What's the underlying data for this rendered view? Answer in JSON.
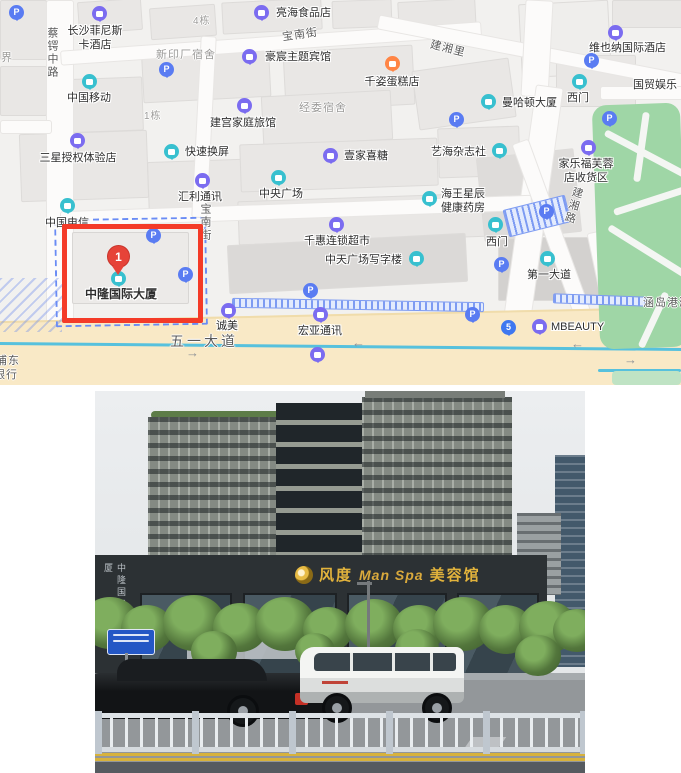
{
  "map": {
    "marker": {
      "number": "1",
      "label": "中隆国际大厦"
    },
    "streets": [
      {
        "t": "蔡锷中路",
        "x": 44,
        "y": 27,
        "vert": 1,
        "c": "dark"
      },
      {
        "t": "界",
        "x": 1,
        "y": 49,
        "c": "gray"
      },
      {
        "t": "宝南街",
        "x": 282,
        "y": 26,
        "rot": -8,
        "c": "dark"
      },
      {
        "t": "宝南街",
        "x": 197,
        "y": 203,
        "vert": 1,
        "c": "dark"
      },
      {
        "t": "建湘里",
        "x": 430,
        "y": 40,
        "rot": 14,
        "c": "dark"
      },
      {
        "t": "建湘路",
        "x": 565,
        "y": 186,
        "vert": 1,
        "rot": 16,
        "c": "dark"
      },
      {
        "t": "五一大道",
        "x": 170,
        "y": 331,
        "size": 14,
        "c": "dark",
        "ls": 3
      },
      {
        "t": "新印厂宿舍",
        "x": 156,
        "y": 46,
        "c": "gray"
      },
      {
        "t": "经委宿舍",
        "x": 299,
        "y": 99,
        "c": "gray"
      },
      {
        "t": "4栋",
        "x": 193,
        "y": 12,
        "c": "gray",
        "size": 10
      },
      {
        "t": "1栋",
        "x": 144,
        "y": 107,
        "c": "gray",
        "size": 10
      },
      {
        "t": "浦东",
        "x": -4,
        "y": 352,
        "c": "dark"
      },
      {
        "t": "银行",
        "x": -6,
        "y": 366,
        "c": "dark"
      },
      {
        "t": "涵岛港湾",
        "x": 643,
        "y": 294,
        "c": "dark"
      }
    ],
    "pois": [
      {
        "n": "changsha-finisi-hotel",
        "icon": {
          "c": "purple",
          "x": 100,
          "y": 14
        },
        "label": {
          "t": "长沙菲尼斯\n卡酒店",
          "x": 95,
          "y": 25,
          "a": "c"
        }
      },
      {
        "n": "lianghai-food-store",
        "icon": {
          "c": "purple",
          "x": 262,
          "y": 13
        },
        "label": {
          "t": "亮海食品店",
          "x": 276,
          "y": 7,
          "a": "l"
        }
      },
      {
        "n": "haochen-theme-hotel",
        "icon": {
          "c": "purple",
          "x": 250,
          "y": 57
        },
        "label": {
          "t": "豪宸主题宾馆",
          "x": 265,
          "y": 51,
          "a": "l"
        }
      },
      {
        "n": "qianzi-cake-shop",
        "icon": {
          "c": "orange",
          "x": 393,
          "y": 64
        },
        "label": {
          "t": "千姿蛋糕店",
          "x": 392,
          "y": 76,
          "a": "c"
        }
      },
      {
        "n": "vienna-intl-hotel",
        "icon": {
          "c": "purple",
          "x": 616,
          "y": 33
        },
        "label": {
          "t": "维也纳国际酒店",
          "x": 589,
          "y": 42,
          "a": "l"
        }
      },
      {
        "n": "guomao-entertainment",
        "label": {
          "t": "国贸娱乐",
          "x": 633,
          "y": 79,
          "a": "l"
        }
      },
      {
        "n": "ximen-gate-north",
        "icon": {
          "c": "teal",
          "x": 580,
          "y": 82
        },
        "label": {
          "t": "西门",
          "x": 578,
          "y": 92,
          "a": "c"
        }
      },
      {
        "n": "manhattan-tower",
        "icon": {
          "c": "teal",
          "x": 489,
          "y": 102
        },
        "label": {
          "t": "曼哈顿大厦",
          "x": 502,
          "y": 97,
          "a": "l"
        }
      },
      {
        "n": "china-mobile",
        "icon": {
          "c": "teal",
          "x": 90,
          "y": 82
        },
        "label": {
          "t": "中国移动",
          "x": 89,
          "y": 92,
          "a": "c"
        }
      },
      {
        "n": "jiangong-family-inn",
        "icon": {
          "c": "purple",
          "x": 245,
          "y": 106
        },
        "label": {
          "t": "建宫家庭旅馆",
          "x": 243,
          "y": 117,
          "a": "c"
        }
      },
      {
        "n": "kuaisu-screen-repair",
        "icon": {
          "c": "teal",
          "x": 172,
          "y": 152
        },
        "label": {
          "t": "快速换屏",
          "x": 185,
          "y": 146,
          "a": "l"
        }
      },
      {
        "n": "samsung-store",
        "icon": {
          "c": "purple",
          "x": 78,
          "y": 141
        },
        "label": {
          "t": "三星授权体验店",
          "x": 78,
          "y": 152,
          "a": "c"
        }
      },
      {
        "n": "huili-telecom",
        "icon": {
          "c": "purple",
          "x": 203,
          "y": 181
        },
        "label": {
          "t": "汇利通讯",
          "x": 200,
          "y": 191,
          "a": "c"
        }
      },
      {
        "n": "china-telecom",
        "icon": {
          "c": "teal",
          "x": 68,
          "y": 206
        },
        "label": {
          "t": "中国电信",
          "x": 67,
          "y": 217,
          "a": "c"
        }
      },
      {
        "n": "yijia-candy",
        "icon": {
          "c": "purple",
          "x": 331,
          "y": 156
        },
        "label": {
          "t": "壹家喜糖",
          "x": 344,
          "y": 150,
          "a": "l"
        }
      },
      {
        "n": "zhongyang-plaza",
        "icon": {
          "c": "teal",
          "x": 279,
          "y": 178
        },
        "label": {
          "t": "中央广场",
          "x": 281,
          "y": 188,
          "a": "c"
        }
      },
      {
        "n": "yihai-magazine",
        "icon": {
          "c": "teal",
          "x": 500,
          "y": 151
        },
        "label": {
          "t": "艺海杂志社",
          "x": 431,
          "y": 146,
          "a": "l"
        }
      },
      {
        "n": "carrefour-pickup",
        "icon": {
          "c": "purple",
          "x": 589,
          "y": 148
        },
        "label": {
          "t": "家乐福芙蓉\n店收货区",
          "x": 586,
          "y": 158,
          "a": "c"
        }
      },
      {
        "n": "haiwang-pharmacy",
        "icon": {
          "c": "teal",
          "x": 430,
          "y": 199
        },
        "label": {
          "t": "海王星辰\n健康药房",
          "x": 441,
          "y": 188,
          "a": "l"
        }
      },
      {
        "n": "qianhui-supermarket",
        "icon": {
          "c": "purple",
          "x": 337,
          "y": 225
        },
        "label": {
          "t": "千惠连锁超市",
          "x": 337,
          "y": 235,
          "a": "c"
        }
      },
      {
        "n": "zhongtian-office-tower",
        "icon": {
          "c": "teal",
          "x": 417,
          "y": 259
        },
        "label": {
          "t": "中天广场写字楼",
          "x": 325,
          "y": 254,
          "a": "l"
        }
      },
      {
        "n": "ximen-gate-mid",
        "icon": {
          "c": "teal",
          "x": 496,
          "y": 225
        },
        "label": {
          "t": "西门",
          "x": 497,
          "y": 236,
          "a": "c"
        }
      },
      {
        "n": "diyi-avenue",
        "icon": {
          "c": "teal",
          "x": 548,
          "y": 259
        },
        "label": {
          "t": "第一大道",
          "x": 549,
          "y": 269,
          "a": "c"
        }
      },
      {
        "n": "chengmei",
        "icon": {
          "c": "purple",
          "x": 229,
          "y": 311
        },
        "label": {
          "t": "诚美",
          "x": 227,
          "y": 320,
          "a": "c"
        }
      },
      {
        "n": "hongya-telecom",
        "icon": {
          "c": "purple",
          "x": 321,
          "y": 315
        },
        "label": {
          "t": "宏亚通讯",
          "x": 320,
          "y": 325,
          "a": "c"
        }
      },
      {
        "n": "mbeauty",
        "icon": {
          "c": "purple",
          "x": 540,
          "y": 327
        },
        "label": {
          "t": "MBEAUTY",
          "x": 551,
          "y": 321,
          "a": "l"
        }
      }
    ],
    "metro_badge": {
      "t": "5",
      "x": 509,
      "y": 328
    },
    "bus_stop": {
      "x": 318,
      "y": 355
    },
    "parking_positions": [
      {
        "x": 17,
        "y": 13
      },
      {
        "x": 167,
        "y": 70
      },
      {
        "x": 592,
        "y": 61
      },
      {
        "x": 610,
        "y": 119
      },
      {
        "x": 457,
        "y": 120
      },
      {
        "x": 154,
        "y": 236
      },
      {
        "x": 186,
        "y": 275
      },
      {
        "x": 311,
        "y": 291
      },
      {
        "x": 502,
        "y": 265
      },
      {
        "x": 473,
        "y": 315
      },
      {
        "x": 547,
        "y": 212
      }
    ],
    "arrows": [
      {
        "x": 352,
        "y": 336,
        "d": "←"
      },
      {
        "x": 571,
        "y": 337,
        "d": "←"
      },
      {
        "x": 624,
        "y": 353,
        "d": "→"
      },
      {
        "x": 186,
        "y": 346,
        "d": "→"
      }
    ],
    "colors": {
      "purple": "#7b6cf0",
      "teal": "#38c0cf",
      "blue": "#5a7cf2",
      "orange": "#ff8545",
      "red_box": "#f43b28",
      "pin": "#e64338",
      "dashed_border": "#6a8cf5",
      "road_yellow": "#f9e9c6",
      "park_green": "#9fd6a6",
      "cyan_line": "#57c1dd"
    }
  },
  "photo": {
    "storefront_sign": {
      "brand": "风度",
      "middle": "Man Spa",
      "suffix": "美容馆"
    },
    "building_vertical_sign": "中隆国际大厦",
    "sign_gold": "#e2b33c"
  }
}
